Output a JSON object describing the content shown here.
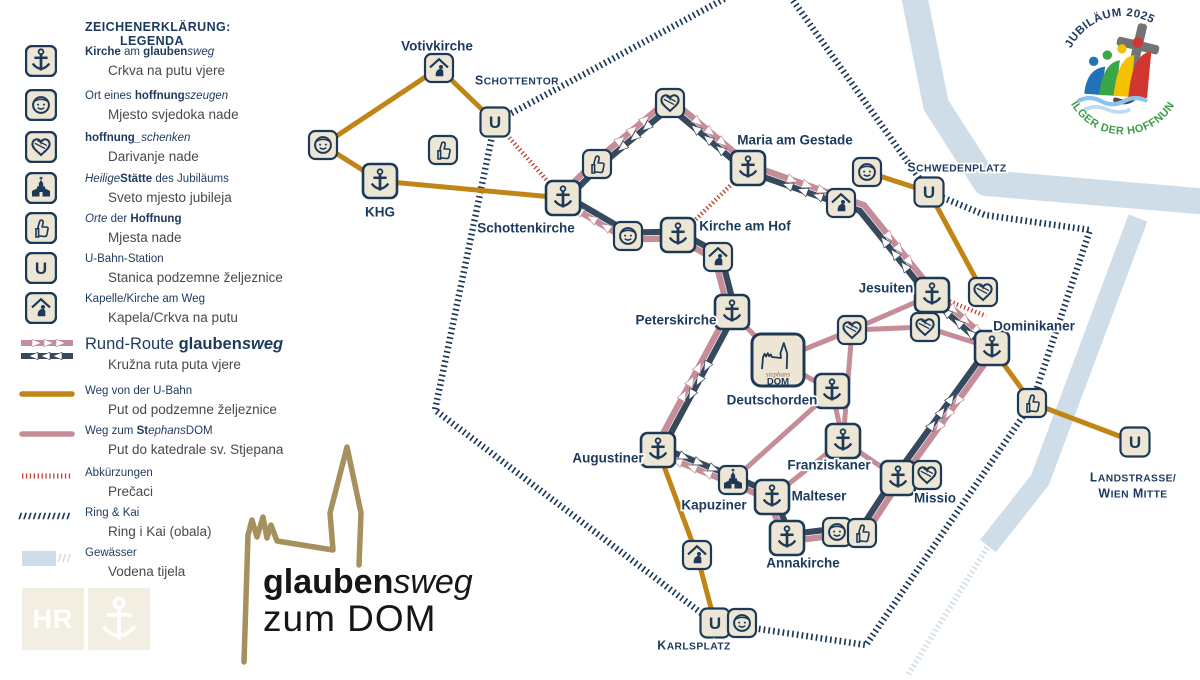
{
  "colors": {
    "navy": "#1c3a58",
    "label": "#1c3a5e",
    "orange": "#c08514",
    "pink": "#c48d98",
    "dark_route": "#37495d",
    "red_dotted": "#c23b2a",
    "water": "#cfdde8",
    "icon_bg": "#ede6d4",
    "gold": "#a5905e",
    "badge_green": "#3a9e46",
    "badge_navy": "#1e3a5f",
    "stephans_text": "#9b6a5a"
  },
  "legend": {
    "title_line1": "ZEICHENERKLÄRUNG:",
    "title_line2": "LEGENDA",
    "items": [
      {
        "icon": "anchor",
        "y": 45,
        "de": [
          [
            "Kirche",
            "b"
          ],
          [
            " am ",
            ""
          ],
          [
            "glauben",
            "b"
          ],
          [
            "sweg",
            "i"
          ]
        ],
        "hr": "Crkva na putu vjere"
      },
      {
        "icon": "smiley",
        "y": 89,
        "de": [
          [
            "Ort eines ",
            ""
          ],
          [
            "hoffnung",
            "b"
          ],
          [
            "szeugen",
            "i"
          ]
        ],
        "hr": "Mjesto svjedoka nade"
      },
      {
        "icon": "heart",
        "y": 131,
        "de": [
          [
            "hoffnung",
            "b"
          ],
          [
            "_schenken",
            "i"
          ]
        ],
        "hr": "Darivanje nade"
      },
      {
        "icon": "church",
        "y": 172,
        "de": [
          [
            "Heilige",
            "i"
          ],
          [
            "Stätte",
            "b"
          ],
          [
            " des Jubiläums",
            ""
          ]
        ],
        "hr": "Sveto mjesto jubileja"
      },
      {
        "icon": "thumb",
        "y": 212,
        "de": [
          [
            "Orte",
            "i"
          ],
          [
            " der ",
            ""
          ],
          [
            "Hoffnung",
            "b"
          ]
        ],
        "hr": "Mjesta nade"
      },
      {
        "icon": "ubahn",
        "y": 252,
        "de": [
          [
            "U-Bahn-Station",
            ""
          ]
        ],
        "hr": "Stanica podzemne željeznice"
      },
      {
        "icon": "chapel",
        "y": 292,
        "de": [
          [
            "Kapelle/Kirche am Weg",
            ""
          ]
        ],
        "hr": "Kapela/Crkva na putu"
      },
      {
        "icon": "sw-route",
        "y": 336,
        "big": true,
        "de": [
          [
            "Rund-Route ",
            ""
          ],
          [
            "glauben",
            "b"
          ],
          [
            "sweg",
            "bi"
          ]
        ],
        "hr": "Kružna ruta puta vjere"
      },
      {
        "icon": "sw-orange",
        "y": 384,
        "de": [
          [
            "Weg von der U-Bahn",
            ""
          ]
        ],
        "hr": "Put od podzemne željeznice"
      },
      {
        "icon": "sw-pink",
        "y": 424,
        "de": [
          [
            "Weg zum ",
            ""
          ],
          [
            "St",
            "b"
          ],
          [
            "ephans",
            "i"
          ],
          [
            "DOM",
            ""
          ]
        ],
        "hr": "Put do katedrale sv. Stjepana"
      },
      {
        "icon": "sw-dotted",
        "y": 466,
        "de": [
          [
            "Abkürzungen",
            ""
          ]
        ],
        "hr": "Prečaci"
      },
      {
        "icon": "sw-hatch",
        "y": 506,
        "de": [
          [
            "Ring & Kai",
            ""
          ]
        ],
        "hr": "Ring i Kai (obala)"
      },
      {
        "icon": "sw-water",
        "y": 546,
        "de": [
          [
            "Gewässer",
            ""
          ]
        ],
        "hr": "Vodena tijela"
      }
    ]
  },
  "watermark": {
    "hr": "HR"
  },
  "logo": {
    "part_bold": "glauben",
    "part_italic": "sweg",
    "line2": "zum DOM"
  },
  "badge": {
    "arc_top": "JUBILÄUM 2025",
    "arc_bottom": "PILGER DER HOFFNUNG"
  },
  "map": {
    "u_label": "U",
    "dom_label": {
      "stephans": "stephans",
      "dom": "DOM"
    },
    "nodes": [
      {
        "id": "votivkirche",
        "type": "chapel",
        "x": 439,
        "y": 68
      },
      {
        "id": "schottentor-u",
        "type": "ubahn",
        "x": 495,
        "y": 122
      },
      {
        "id": "smiley-nw",
        "type": "smiley",
        "x": 323,
        "y": 145
      },
      {
        "id": "thumb-nw",
        "type": "thumb",
        "x": 443,
        "y": 150
      },
      {
        "id": "khg",
        "type": "anchor",
        "x": 380,
        "y": 181
      },
      {
        "id": "schottenkirche",
        "type": "anchor",
        "x": 563,
        "y": 198
      },
      {
        "id": "thumb-n",
        "type": "thumb",
        "x": 597,
        "y": 164
      },
      {
        "id": "heart-n",
        "type": "heart",
        "x": 670,
        "y": 103
      },
      {
        "id": "maria-am-gestade",
        "type": "anchor",
        "x": 748,
        "y": 168
      },
      {
        "id": "smiley-ne",
        "type": "smiley",
        "x": 867,
        "y": 172
      },
      {
        "id": "chapel-ne",
        "type": "chapel",
        "x": 841,
        "y": 203
      },
      {
        "id": "schwedenplatz-u",
        "type": "ubahn",
        "x": 929,
        "y": 192
      },
      {
        "id": "smiley-hof",
        "type": "smiley",
        "x": 628,
        "y": 236
      },
      {
        "id": "kirche-am-hof",
        "type": "anchor",
        "x": 678,
        "y": 235
      },
      {
        "id": "chapel-hof",
        "type": "chapel",
        "x": 718,
        "y": 257
      },
      {
        "id": "peterskirche",
        "type": "anchor",
        "x": 732,
        "y": 312
      },
      {
        "id": "jesuiten",
        "type": "anchor",
        "x": 932,
        "y": 295
      },
      {
        "id": "heart-jesuiten",
        "type": "heart",
        "x": 983,
        "y": 292
      },
      {
        "id": "heart-mid-e",
        "type": "heart",
        "x": 925,
        "y": 327
      },
      {
        "id": "heart-mid",
        "type": "heart",
        "x": 852,
        "y": 330
      },
      {
        "id": "dominikaner",
        "type": "anchor",
        "x": 992,
        "y": 348
      },
      {
        "id": "stephansdom",
        "type": "dom",
        "x": 778,
        "y": 360
      },
      {
        "id": "deutschorden",
        "type": "anchor",
        "x": 832,
        "y": 391
      },
      {
        "id": "thumb-e",
        "type": "thumb",
        "x": 1032,
        "y": 403
      },
      {
        "id": "landstrasse-u",
        "type": "ubahn",
        "x": 1135,
        "y": 442
      },
      {
        "id": "franziskaner",
        "type": "anchor",
        "x": 843,
        "y": 441
      },
      {
        "id": "augustiner",
        "type": "anchor",
        "x": 658,
        "y": 450
      },
      {
        "id": "kapuziner",
        "type": "church",
        "x": 733,
        "y": 480
      },
      {
        "id": "missio",
        "type": "anchor",
        "x": 898,
        "y": 478
      },
      {
        "id": "heart-missio",
        "type": "heart",
        "x": 927,
        "y": 475
      },
      {
        "id": "malteser",
        "type": "anchor",
        "x": 772,
        "y": 497
      },
      {
        "id": "annakirche",
        "type": "anchor",
        "x": 787,
        "y": 538
      },
      {
        "id": "smiley-anna",
        "type": "smiley",
        "x": 837,
        "y": 532
      },
      {
        "id": "thumb-anna",
        "type": "thumb",
        "x": 862,
        "y": 533
      },
      {
        "id": "chapel-s",
        "type": "chapel",
        "x": 697,
        "y": 555
      },
      {
        "id": "karlsplatz-u",
        "type": "ubahn",
        "x": 715,
        "y": 623
      },
      {
        "id": "smiley-karls",
        "type": "smiley",
        "x": 742,
        "y": 623
      }
    ],
    "labels": [
      {
        "t": "Votivkirche",
        "x": 437,
        "y": 46,
        "s": "place"
      },
      {
        "t": "Schottentor",
        "x": 517,
        "y": 80,
        "s": "station"
      },
      {
        "t": "KHG",
        "x": 380,
        "y": 212,
        "s": "place"
      },
      {
        "t": "Schottenkirche",
        "x": 526,
        "y": 228,
        "s": "place"
      },
      {
        "t": "Maria am Gestade",
        "x": 795,
        "y": 140,
        "s": "place"
      },
      {
        "t": "Kirche am Hof",
        "x": 745,
        "y": 226,
        "s": "place"
      },
      {
        "t": "Schwedenplatz",
        "x": 957,
        "y": 167,
        "s": "station"
      },
      {
        "t": "Jesuiten",
        "x": 886,
        "y": 288,
        "s": "place"
      },
      {
        "t": "Dominikaner",
        "x": 1034,
        "y": 326,
        "s": "place"
      },
      {
        "t": "Peterskirche",
        "x": 676,
        "y": 320,
        "s": "place"
      },
      {
        "t": "Deutschorden",
        "x": 772,
        "y": 400,
        "s": "place"
      },
      {
        "t": "Franziskaner",
        "x": 829,
        "y": 465,
        "s": "place"
      },
      {
        "t": "Malteser",
        "x": 819,
        "y": 496,
        "s": "place"
      },
      {
        "t": "Missio",
        "x": 935,
        "y": 498,
        "s": "place"
      },
      {
        "t": "Augustiner",
        "x": 608,
        "y": 458,
        "s": "place"
      },
      {
        "t": "Kapuziner",
        "x": 714,
        "y": 505,
        "s": "place"
      },
      {
        "t": "Annakirche",
        "x": 803,
        "y": 563,
        "s": "place"
      },
      {
        "t": "Karlsplatz",
        "x": 694,
        "y": 645,
        "s": "station"
      },
      {
        "t": "Landstrasse/",
        "x": 1133,
        "y": 477,
        "s": "station"
      },
      {
        "t": "Wien Mitte",
        "x": 1133,
        "y": 493,
        "s": "station"
      }
    ],
    "loop": [
      [
        563,
        198
      ],
      [
        597,
        164
      ],
      [
        670,
        103
      ],
      [
        748,
        168
      ],
      [
        862,
        208
      ],
      [
        932,
        295
      ],
      [
        992,
        348
      ],
      [
        898,
        478
      ],
      [
        862,
        533
      ],
      [
        837,
        532
      ],
      [
        787,
        538
      ],
      [
        772,
        497
      ],
      [
        733,
        480
      ],
      [
        658,
        450
      ],
      [
        732,
        312
      ],
      [
        718,
        257
      ],
      [
        678,
        235
      ],
      [
        628,
        236
      ]
    ],
    "orange": [
      [
        [
          323,
          145
        ],
        [
          439,
          68
        ]
      ],
      [
        [
          439,
          68
        ],
        [
          495,
          122
        ]
      ],
      [
        [
          323,
          145
        ],
        [
          380,
          181
        ]
      ],
      [
        [
          380,
          181
        ],
        [
          563,
          198
        ]
      ],
      [
        [
          929,
          192
        ],
        [
          867,
          172
        ]
      ],
      [
        [
          929,
          192
        ],
        [
          983,
          292
        ]
      ],
      [
        [
          992,
          348
        ],
        [
          1032,
          403
        ]
      ],
      [
        [
          1032,
          403
        ],
        [
          1135,
          442
        ]
      ],
      [
        [
          715,
          623
        ],
        [
          697,
          555
        ],
        [
          658,
          450
        ]
      ]
    ],
    "pink": [
      [
        [
          778,
          360
        ],
        [
          732,
          312
        ]
      ],
      [
        [
          778,
          360
        ],
        [
          852,
          330
        ]
      ],
      [
        [
          852,
          330
        ],
        [
          925,
          327
        ]
      ],
      [
        [
          852,
          330
        ],
        [
          932,
          295
        ]
      ],
      [
        [
          925,
          327
        ],
        [
          992,
          348
        ]
      ],
      [
        [
          852,
          330
        ],
        [
          843,
          441
        ]
      ],
      [
        [
          832,
          391
        ],
        [
          778,
          360
        ]
      ],
      [
        [
          832,
          391
        ],
        [
          733,
          480
        ]
      ],
      [
        [
          832,
          391
        ],
        [
          843,
          441
        ]
      ],
      [
        [
          843,
          441
        ],
        [
          772,
          497
        ]
      ],
      [
        [
          843,
          441
        ],
        [
          898,
          478
        ]
      ]
    ],
    "dotted": [
      [
        [
          499,
          126
        ],
        [
          558,
          193
        ]
      ],
      [
        [
          744,
          172
        ],
        [
          684,
          231
        ]
      ],
      [
        [
          946,
          300
        ],
        [
          986,
          316
        ]
      ]
    ],
    "ring": [
      [
        737,
        -8
      ],
      [
        495,
        122
      ],
      [
        435,
        410
      ],
      [
        713,
        622
      ],
      [
        866,
        645
      ],
      [
        1032,
        403
      ],
      [
        1090,
        230
      ],
      [
        985,
        215
      ],
      [
        929,
        192
      ],
      [
        787,
        -8
      ]
    ],
    "ring_faint": [
      [
        992,
        540
      ],
      [
        906,
        678
      ]
    ],
    "water": [
      {
        "pts": [
          [
            912,
            -15
          ],
          [
            936,
            105
          ],
          [
            986,
            183
          ],
          [
            1210,
            202
          ]
        ],
        "w": 26
      },
      {
        "pts": [
          [
            1138,
            218
          ],
          [
            1040,
            480
          ],
          [
            988,
            546
          ]
        ],
        "w": 20
      }
    ]
  }
}
